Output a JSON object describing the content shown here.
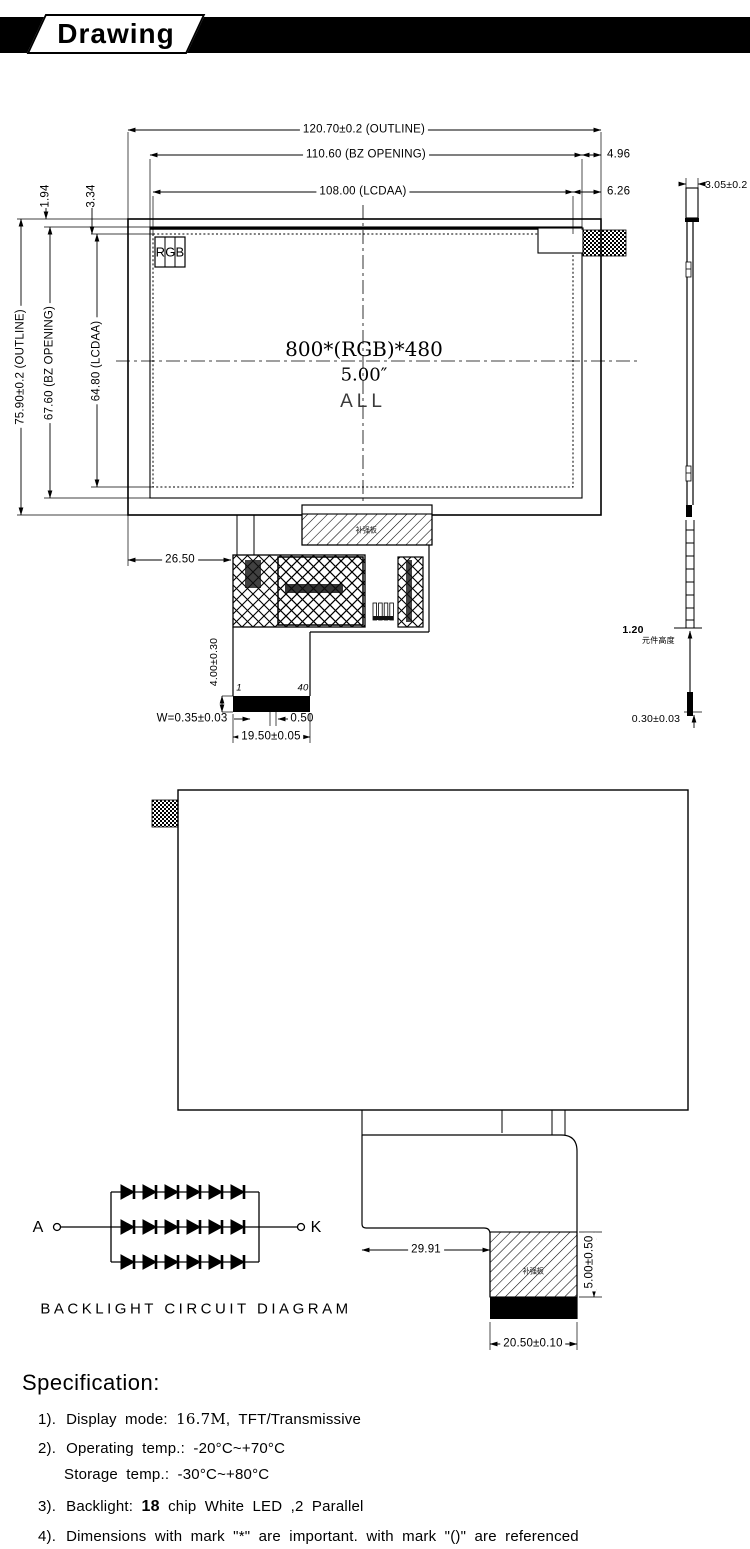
{
  "header": {
    "title": "Drawing"
  },
  "front_view": {
    "dim_outline_width": "120.70±0.2 (OUTLINE)",
    "dim_bz_width": "110.60 (BZ OPENING)",
    "dim_lcdaa_width": "108.00 (LCDAA)",
    "dim_right_edge_to_bz": "4.96",
    "dim_right_edge_to_lcdaa": "6.26",
    "dim_outline_height": "75.90±0.2 (OUTLINE)",
    "dim_bz_height": "67.60 (BZ OPENING)",
    "dim_lcdaa_height": "64.80 (LCDAA)",
    "dim_top_edge_to_bz": "1.94",
    "dim_top_edge_to_lcdaa": "3.34",
    "dim_fpc_offset": "26.50",
    "dim_connector_height": "4.00±0.30",
    "dim_pin_width": "W=0.35±0.03",
    "dim_pin_pitch": "0.50",
    "dim_connector_width": "19.50±0.05",
    "pin_first": "1",
    "pin_last": "40",
    "rgb_label": "RGB",
    "resolution": "800*(RGB)*480",
    "diagonal_size": "5.00″",
    "all_label": "ALL",
    "stiffener_label": "补强板"
  },
  "side_view": {
    "dim_thickness": "3.05±0.2",
    "dim_component_height": "1.20",
    "component_height_label": "元件高度",
    "dim_fpc_thickness": "0.30±0.03"
  },
  "rear_view": {
    "dim_fpc_offset": "29.91",
    "dim_stiffener_height": "5.00±0.50",
    "dim_connector_width": "20.50±0.10",
    "stiffener_label": "补强板"
  },
  "backlight_circuit": {
    "anode_label": "A",
    "cathode_label": "K",
    "caption": "BACKLIGHT CIRCUIT DIAGRAM",
    "led_rows": 3,
    "leds_per_row": 6
  },
  "specification": {
    "title": "Specification:",
    "item1_num": "1).",
    "item1_text": "Display mode:",
    "item1_serif": "16.7M",
    "item1_rest": ", TFT/Transmissive",
    "item2_num": "2).",
    "item2_text": "Operating temp.: -20°C~+70°C",
    "item2b_text": "Storage temp.: -30°C~+80°C",
    "item3_num": "3).",
    "item3_text": "Backlight:",
    "item3_bold": "18",
    "item3_rest": "chip White LED ,2 Parallel",
    "item4_num": "4).",
    "item4_text": "Dimensions with mark \"*\" are important. with mark \"()\" are referenced"
  }
}
